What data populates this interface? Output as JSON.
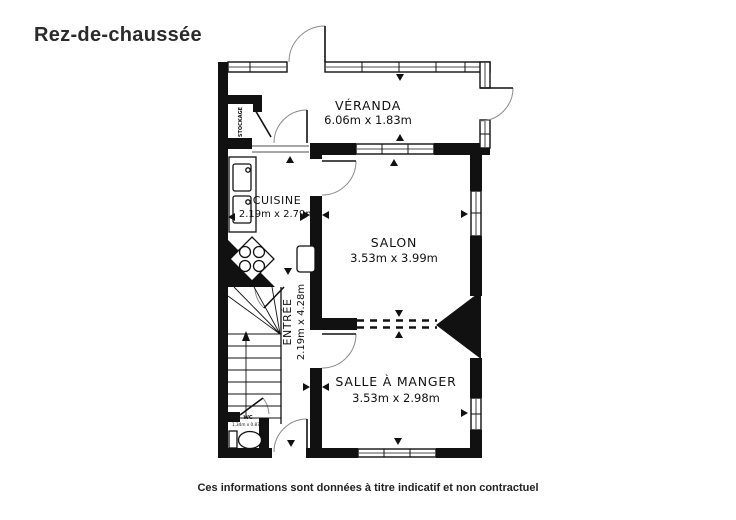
{
  "title": "Rez-de-chaussée",
  "footer": "Ces informations sont données à titre indicatif et non contractuel",
  "colors": {
    "wall": "#111111",
    "text": "#111111",
    "background": "#ffffff"
  },
  "rooms": {
    "veranda": {
      "name": "VÉRANDA",
      "dims": "6.06m x 1.83m"
    },
    "cuisine": {
      "name": "CUISINE",
      "dims": "2.19m x 2.79m"
    },
    "salon": {
      "name": "SALON",
      "dims": "3.53m x 3.99m"
    },
    "entree": {
      "name": "ENTRÉE",
      "dims": "2.19m x 4.28m"
    },
    "salle_a_manger": {
      "name": "SALLE À MANGER",
      "dims": "3.53m x 2.98m"
    },
    "wc": {
      "name": "WC",
      "dims": "1.34m x 0.87m"
    },
    "stockage": {
      "name": "STOCKAGE"
    }
  }
}
